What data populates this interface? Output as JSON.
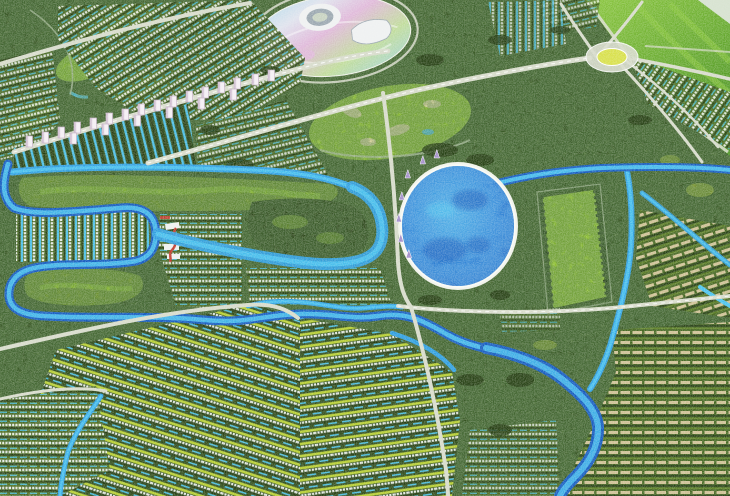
{
  "scene": {
    "kind": "photo-of-architectural-scale-model",
    "subject": "master-planned township: winding river, golf courses, oval central lake, dense housing rows, high-rise tower boulevard, stadium complex, roundabout, green hillside"
  },
  "palette": {
    "base_forest": "#2f4d1b",
    "canopy_mid": "#46671f",
    "canopy_light": "#6f9427",
    "canopy_dark": "#22390f",
    "lawn_chartreuse": "#bdd431",
    "lawn_bright": "#8fc22c",
    "hill_green": "#56a028",
    "hill_light": "#8ac63e",
    "river_blue": "#2f9fe0",
    "river_deep": "#155cc0",
    "canal_cyan": "#49c3f0",
    "lake_fill": "#2b80d5",
    "lake_deep": "#1854b6",
    "lake_light": "#57c9f1",
    "beach": "#f1f3eb",
    "road": "#d7dbcb",
    "road_dim": "#b8c1ab",
    "house_white": "#eef1ef",
    "house_tan": "#dcca9e",
    "tower_white": "#f5eff5",
    "tower_shade": "#c3aec5",
    "stadium_white": "#eff1f2",
    "stadium_mid": "#9aa7b0",
    "infield": "#c8d3c2",
    "pastel_blue": "#a7d8e9",
    "pastel_pink": "#e0b8da",
    "pastel_green": "#c0dc9b",
    "sand": "#dad29a",
    "red_accent": "#c03a2b",
    "purple_sail": "#a18cc9",
    "yellow_center": "#d8e04b",
    "haze": "#e3e9e2"
  },
  "features": {
    "lake": "central-oval-lake",
    "river": "serpentine-river-network",
    "stadium": "stadium-entertainment-oval",
    "towers": "high-rise-tower-boulevard",
    "roundabout": "radial-roundabout",
    "golf": "golf-course-loops",
    "housing": "row-housing-with-canals",
    "event_lawn": "rectangular-event-lawn",
    "hillside": "smooth-green-hillside"
  }
}
